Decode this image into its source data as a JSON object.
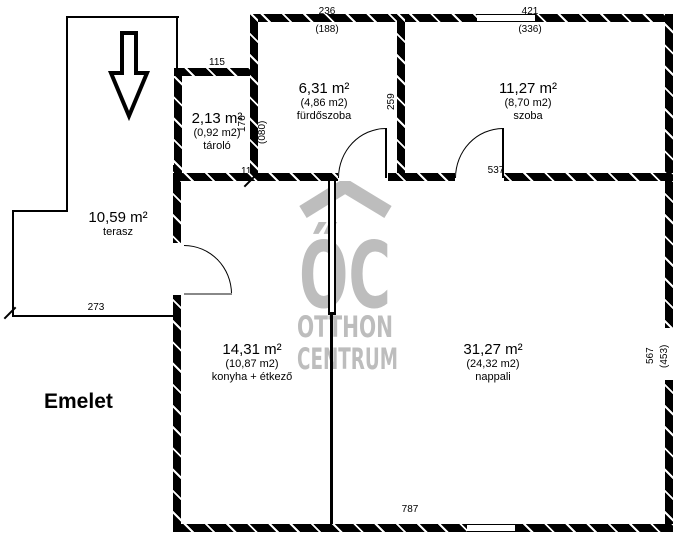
{
  "floor_label": "Emelet",
  "watermark": {
    "logo": "ŐC",
    "line1": "OTTHON",
    "line2": "CENTRUM",
    "color": "#bdbdbd"
  },
  "rooms": [
    {
      "name": "fürdőszoba",
      "area": "6,31 m²",
      "reduced": "(4,86 m2)"
    },
    {
      "name": "szoba",
      "area": "11,27 m²",
      "reduced": "(8,70 m2)"
    },
    {
      "name": "tároló",
      "area": "2,13 m²",
      "reduced": "(0,92 m2)"
    },
    {
      "name": "terasz",
      "area": "10,59 m²"
    },
    {
      "name": "konyha + étkező",
      "area": "14,31 m²",
      "reduced": "(10,87 m2)"
    },
    {
      "name": "nappali",
      "area": "31,27 m²",
      "reduced": "(24,32 m2)"
    }
  ],
  "dims": {
    "furdoszoba_top": "236",
    "furdoszoba_top_reduced": "(188)",
    "szoba_top": "421",
    "szoba_top_reduced": "(336)",
    "tarolo_top": "115",
    "tarolo_right": "176",
    "tarolo_right_reduced": "(080)",
    "furdoszoba_right": "259",
    "szoba_bottom": "537",
    "wall_junction": "110",
    "terasz_bottom": "273",
    "bottom_total": "787",
    "right_side": "567",
    "right_side_reduced": "(453)"
  }
}
